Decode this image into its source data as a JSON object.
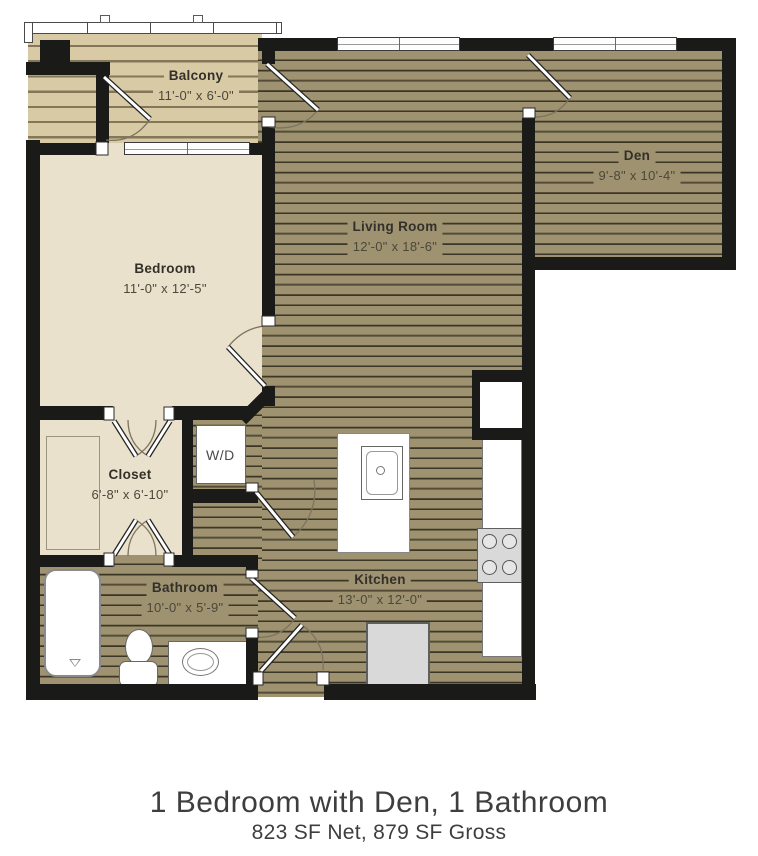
{
  "rooms": {
    "balcony": {
      "name": "Balcony",
      "dims": "11'-0\" x 6'-0\""
    },
    "den": {
      "name": "Den",
      "dims": "9'-8\" x 10'-4\""
    },
    "living_room": {
      "name": "Living Room",
      "dims": "12'-0\" x 18'-6\""
    },
    "bedroom": {
      "name": "Bedroom",
      "dims": "11'-0\" x 12'-5\""
    },
    "closet": {
      "name": "Closet",
      "dims": "6'-8\" x 6'-10\""
    },
    "laundry": {
      "name": "W/D"
    },
    "bathroom": {
      "name": "Bathroom",
      "dims": "10'-0\" x 5'-9\""
    },
    "kitchen": {
      "name": "Kitchen",
      "dims": "13'-0\" x 12'-0\""
    }
  },
  "footer": {
    "title": "1 Bedroom with Den, 1 Bathroom",
    "subtitle": "823 SF Net, 879 SF Gross"
  },
  "colors": {
    "wood_floor": "#9e9270",
    "wood_line": "#3c3627",
    "deck_floor": "#d7caa5",
    "cream_floor": "#e9e1cc",
    "wall": "#1a1a18"
  }
}
